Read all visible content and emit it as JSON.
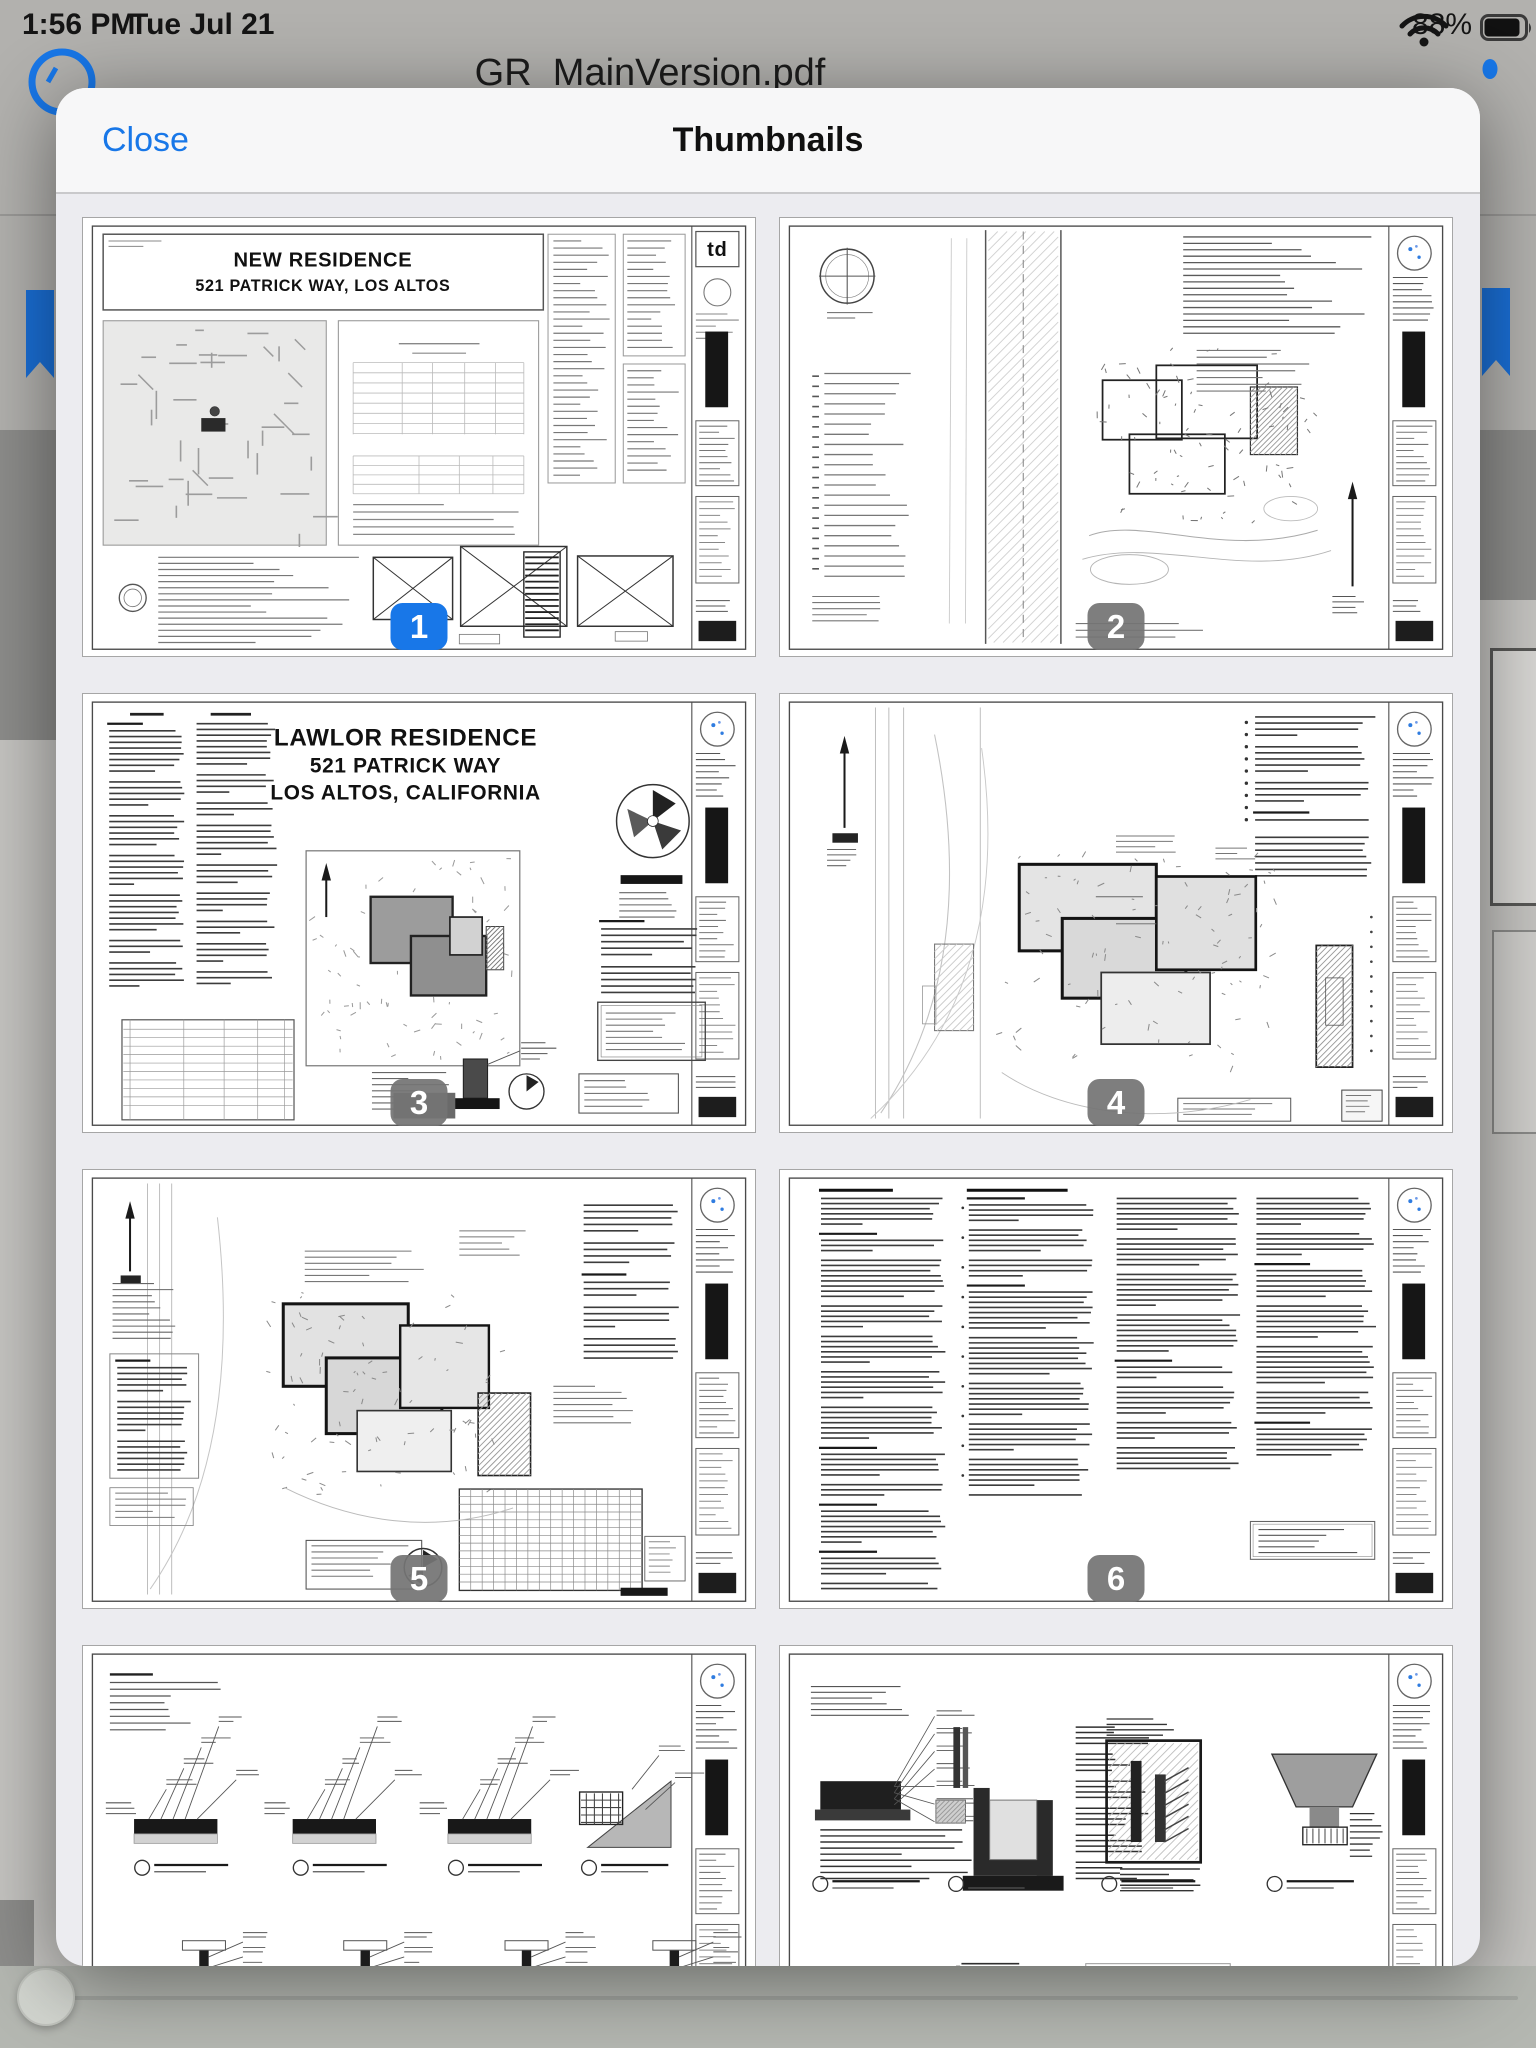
{
  "status_bar": {
    "time": "1:56 PM",
    "date": "Tue Jul 21",
    "battery_percent": "88%",
    "icons": [
      "wifi-icon",
      "battery-icon"
    ]
  },
  "background_app": {
    "document_title": "GR_MainVersion.pdf",
    "icons": [
      "back-circle-icon",
      "bookmark-icon-left",
      "bookmark-icon-right",
      "more-dot-icon",
      "scrubber-thumb"
    ]
  },
  "modal": {
    "close_label": "Close",
    "title": "Thumbnails"
  },
  "colors": {
    "accent_blue": "#1877E8",
    "selected_badge": "#1877E8",
    "badge_gray": "#747474",
    "modal_header_bg": "#F7F7F8",
    "modal_body_bg": "#ECECF0",
    "backdrop_nav": "#B2B1AE",
    "backdrop_content": "#8D8D8B",
    "backdrop_page": "#C5C4C1",
    "backdrop_bottom_bar": "#B4B7B1"
  },
  "thumbnails": [
    {
      "badge": "1",
      "selected": true,
      "kind": "title-sheet",
      "sheet_title_lines": [
        "NEW RESIDENCE",
        "521 PATRICK WAY, LOS ALTOS"
      ],
      "logo_text": "td"
    },
    {
      "badge": "2",
      "selected": false,
      "kind": "survey-plan"
    },
    {
      "badge": "3",
      "selected": false,
      "kind": "cover-site-plan",
      "sheet_title_lines": [
        "LAWLOR RESIDENCE",
        "521 PATRICK WAY",
        "LOS ALTOS, CALIFORNIA"
      ]
    },
    {
      "badge": "4",
      "selected": false,
      "kind": "site-plan"
    },
    {
      "badge": "5",
      "selected": false,
      "kind": "grading-plan"
    },
    {
      "badge": "6",
      "selected": false,
      "kind": "general-notes"
    },
    {
      "badge": null,
      "selected": false,
      "kind": "construction-details"
    },
    {
      "badge": null,
      "selected": false,
      "kind": "construction-details-2"
    }
  ]
}
